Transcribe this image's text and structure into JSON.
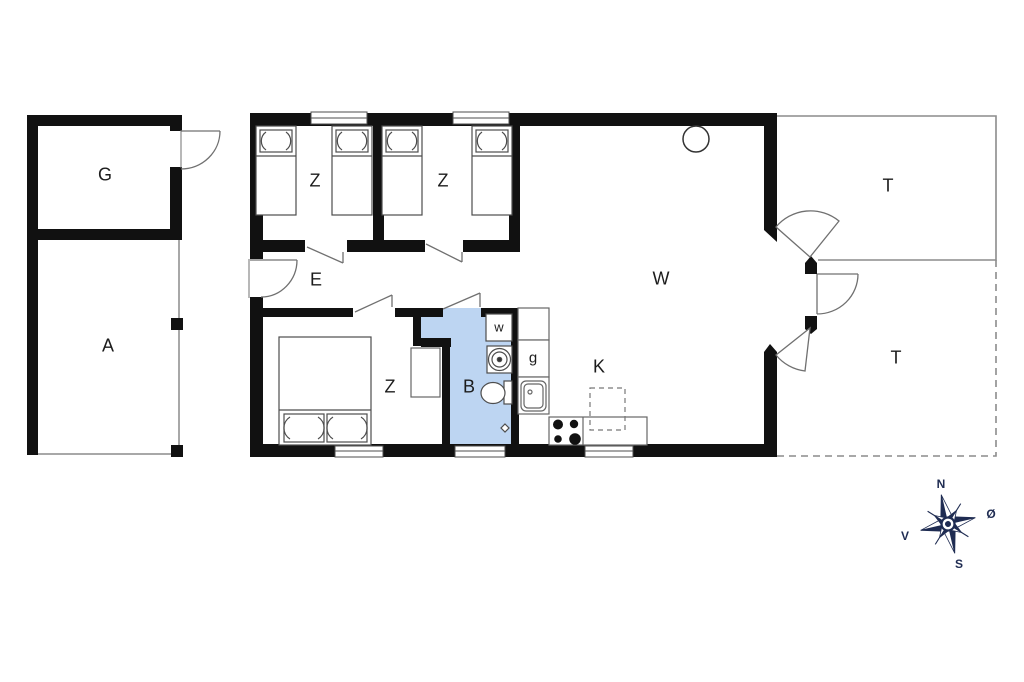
{
  "rooms": [
    {
      "name": "garage",
      "label": "G"
    },
    {
      "name": "annex",
      "label": "A"
    },
    {
      "name": "bedroom-1",
      "label": "Z"
    },
    {
      "name": "bedroom-2",
      "label": "Z"
    },
    {
      "name": "hallway",
      "label": "E"
    },
    {
      "name": "living-room",
      "label": "W"
    },
    {
      "name": "bedroom-3",
      "label": "Z"
    },
    {
      "name": "bathroom",
      "label": "B"
    },
    {
      "name": "kitchen",
      "label": "K"
    },
    {
      "name": "terrace-upper",
      "label": "T"
    },
    {
      "name": "terrace-lower",
      "label": "T"
    }
  ],
  "fixtures": {
    "washing_machine_label": "w",
    "appliance_label": "g"
  },
  "compass": {
    "north": "N",
    "east": "Ø",
    "south": "S",
    "west": "V"
  },
  "colors": {
    "wall": "#111111",
    "bathroom_fill": "#bdd5f2",
    "fixture_line": "#4d4d4d",
    "door_line": "#707070",
    "terrace_line": "#8c8c8c",
    "compass_navy": "#1f2c52"
  }
}
